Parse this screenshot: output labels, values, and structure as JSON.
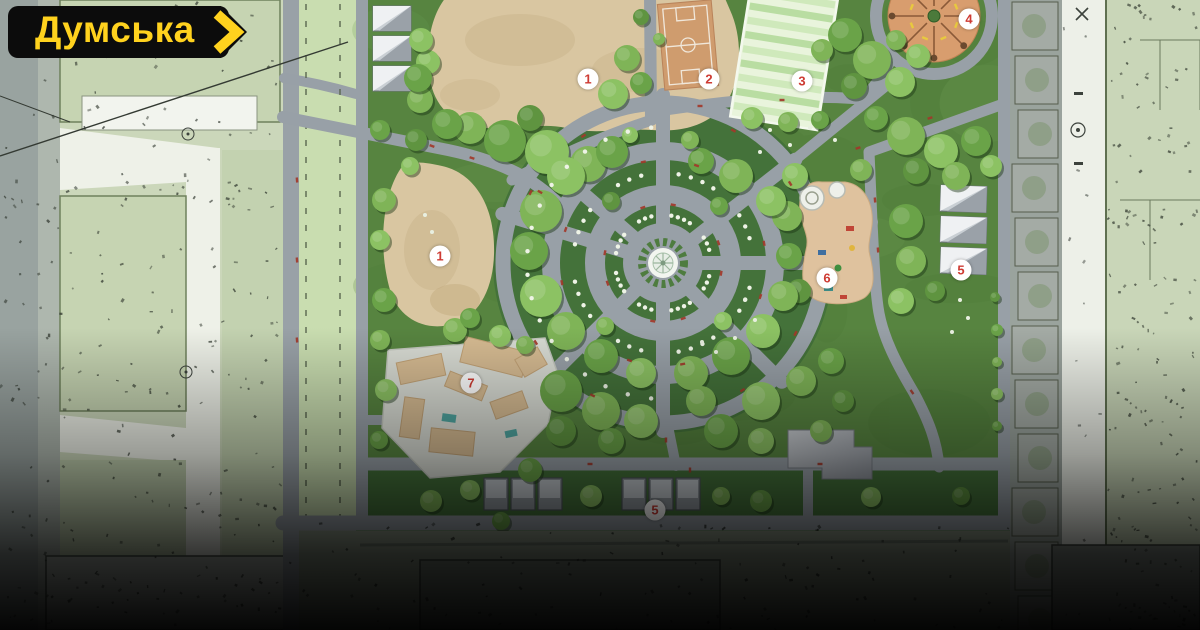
{
  "brand": {
    "logo_text": "Думська"
  },
  "plan": {
    "markers": [
      {
        "label": "1"
      },
      {
        "label": "2"
      },
      {
        "label": "3"
      },
      {
        "label": "4"
      },
      {
        "label": "1"
      },
      {
        "label": "6"
      },
      {
        "label": "5"
      },
      {
        "label": "7"
      },
      {
        "label": "5"
      }
    ]
  },
  "colors": {
    "brand-yellow": "#FFD21E",
    "badge-black": "#0C0C0C",
    "marker-red": "#CE3B33",
    "marker-bg": "#FFFFFF",
    "grass": "#578440",
    "grass-dark": "#44723A",
    "path": "#98A0A7",
    "sand": "#D9C6A1",
    "court": "#CF9C6E",
    "field": "#CFE9BB",
    "fountain": "#F2F5EF"
  }
}
